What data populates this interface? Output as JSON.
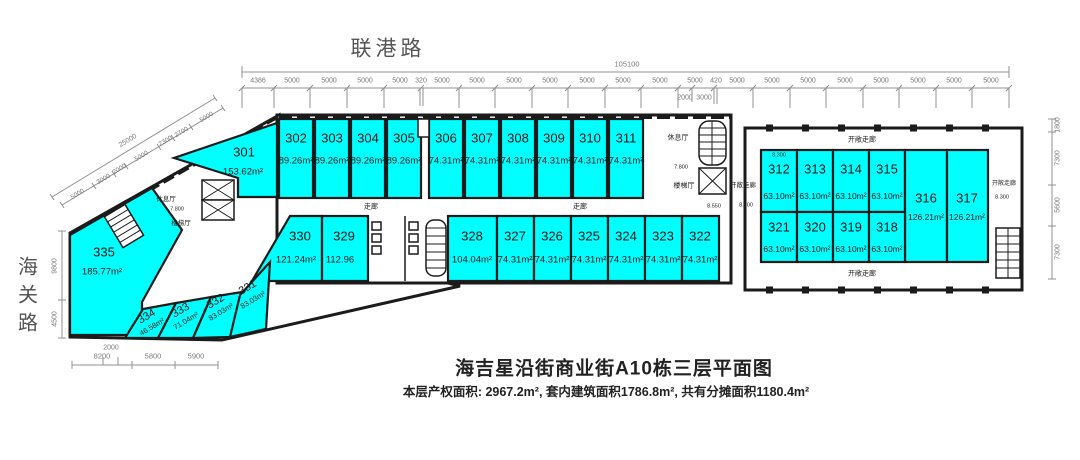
{
  "roads": {
    "top": "联港路",
    "left": "海关路"
  },
  "title": "海吉星沿街商业街A10栋三层平面图",
  "subtitle": "本层产权面积: 2967.2m², 套内建筑面积1786.8m², 共有分摊面积1180.4m²",
  "labels": {
    "corridor": "走廊",
    "open_corridor": "开敞走廊",
    "lounge": "休息厅",
    "stair_hall": "楼梯厅",
    "lv_7800": "7.800",
    "lv_8300": "8.300",
    "lv_8550": "8.550"
  },
  "colors": {
    "unit_fill": "#00ffff",
    "wall": "#1b1b1b",
    "dim_line": "#909090"
  },
  "dims": {
    "top_total": "105100",
    "top": [
      "4386",
      "5000",
      "5000",
      "5000",
      "5000",
      "320",
      "5000",
      "5000",
      "5000",
      "5000",
      "5000",
      "5000",
      "5000",
      "5000",
      "420",
      "5000",
      "5000",
      "5000",
      "5000",
      "5000",
      "5000",
      "5000",
      "5000"
    ],
    "top_sub": [
      "2000",
      "3000"
    ],
    "right": [
      "1800",
      "7300",
      "5600",
      "7300"
    ],
    "left": [
      "9800",
      "4500"
    ],
    "bottom": [
      "8200",
      "5800",
      "5900"
    ],
    "bottom_sub": "2000",
    "diag_total": "25000",
    "diag": [
      "5000",
      "3000",
      "2000",
      "5000",
      "2300",
      "2700",
      "5000"
    ]
  },
  "units": {
    "u301": {
      "id": "301",
      "area": "153.62m²"
    },
    "u302": {
      "id": "302",
      "area": "89.26m²"
    },
    "u303": {
      "id": "303",
      "area": "89.26m²"
    },
    "u304": {
      "id": "304",
      "area": "89.26m²"
    },
    "u305": {
      "id": "305",
      "area": "89.26m²"
    },
    "u306": {
      "id": "306",
      "area": "74.31m²"
    },
    "u307": {
      "id": "307",
      "area": "74.31m²"
    },
    "u308": {
      "id": "308",
      "area": "74.31m²"
    },
    "u309": {
      "id": "309",
      "area": "74.31m²"
    },
    "u310": {
      "id": "310",
      "area": "74.31m²"
    },
    "u311": {
      "id": "311",
      "area": "74.31m²"
    },
    "u312": {
      "id": "312",
      "area": "63.10m²"
    },
    "u313": {
      "id": "313",
      "area": "63.10m²"
    },
    "u314": {
      "id": "314",
      "area": "63.10m²"
    },
    "u315": {
      "id": "315",
      "area": "63.10m²"
    },
    "u316": {
      "id": "316",
      "area": "126.21m²"
    },
    "u317": {
      "id": "317",
      "area": "126.21m²"
    },
    "u318": {
      "id": "318",
      "area": "63.10m²"
    },
    "u319": {
      "id": "319",
      "area": "63.10m²"
    },
    "u320": {
      "id": "320",
      "area": "63.10m²"
    },
    "u321": {
      "id": "321",
      "area": "63.10m²"
    },
    "u322": {
      "id": "322",
      "area": "74.31m²"
    },
    "u323": {
      "id": "323",
      "area": "74.31m²"
    },
    "u324": {
      "id": "324",
      "area": "74.31m²"
    },
    "u325": {
      "id": "325",
      "area": "74.31m²"
    },
    "u326": {
      "id": "326",
      "area": "74.31m²"
    },
    "u327": {
      "id": "327",
      "area": "74.31m²"
    },
    "u328": {
      "id": "328",
      "area": "104.04m²"
    },
    "u329": {
      "id": "329",
      "area": "112.96"
    },
    "u330": {
      "id": "330",
      "area": "121.24m²"
    },
    "u331": {
      "id": "331",
      "area": "83.03m²"
    },
    "u332": {
      "id": "332",
      "area": "83.03m²"
    },
    "u333": {
      "id": "333",
      "area": "71.04m²"
    },
    "u334": {
      "id": "334",
      "area": "46.58m²"
    },
    "u335": {
      "id": "335",
      "area": "185.77m²"
    }
  }
}
